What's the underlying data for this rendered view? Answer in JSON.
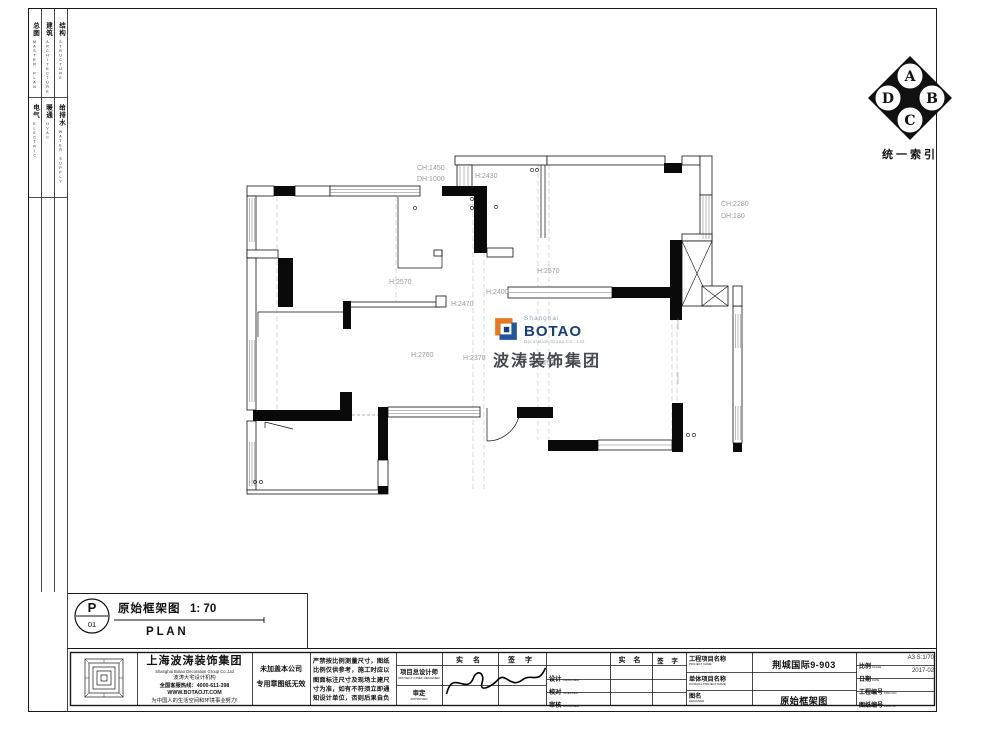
{
  "index_strip": {
    "rows": [
      {
        "cells": [
          {
            "zh": "总图",
            "en": "MASTER PLAN"
          },
          {
            "zh": "建筑",
            "en": "ARCHITECTURE"
          },
          {
            "zh": "结构",
            "en": "STRUCTURE"
          }
        ]
      },
      {
        "cells": [
          {
            "zh": "电气",
            "en": "ELECTRIC"
          },
          {
            "zh": "暖通",
            "en": "HVAC"
          },
          {
            "zh": "给排水",
            "en": "WATER SUPPLY"
          }
        ]
      }
    ]
  },
  "north_index": {
    "a": "A",
    "b": "B",
    "c": "C",
    "d": "D",
    "label": "统一索引"
  },
  "plan": {
    "dims": [
      {
        "text": "CH:1450"
      },
      {
        "text": "DH:1000"
      },
      {
        "text": "H:2430"
      },
      {
        "text": "CH:2280"
      },
      {
        "text": "DH:180"
      },
      {
        "text": "H:2570"
      },
      {
        "text": "H:2400"
      },
      {
        "text": "H:2570"
      },
      {
        "text": "H:2470"
      },
      {
        "text": "H:2760"
      },
      {
        "text": "H:2370"
      },
      {
        "text": "H:2530"
      }
    ],
    "logo": {
      "shanghai": "Shanghai",
      "botao": "BOTAO",
      "sub": "Decoration Group Co., Ltd.",
      "cn": "波涛装饰集团"
    }
  },
  "plan_label": {
    "p": "P",
    "num": "01",
    "title": "原始框架图",
    "scale": "1: 70",
    "plan": "P L A N"
  },
  "titleblock": {
    "company": {
      "name": "上海波涛装饰集团",
      "name_en": "Shanghai Botao Decoration Group Co.,Ltd",
      "org": "波涛大宅设计机构",
      "hotline": "全国客服热线：4000-611-398",
      "website": "WWW.BOTAOJT.COM",
      "slogan": "为中国人的生活空间和环境事业努力!"
    },
    "seal": {
      "line1": "未加盖本公司",
      "line2": "专用章图纸无效"
    },
    "disclaimer": {
      "l1": "严禁按比例测量尺寸，图纸",
      "l2": "比例仅供参考，施工时应以",
      "l3": "图面标注尺寸及现场土建尺",
      "l4": "寸为准，如有不符须立即通",
      "l5": "知设计单位，否则后果自负"
    },
    "cols": {
      "real_name": "实 名",
      "sign": "签 字"
    },
    "roles": {
      "chief_zh": "项目总设计师",
      "chief_en": "PROJECT CHIEF DESIGNER",
      "approved_zh": "审定",
      "approved_en": "APPROVED",
      "designed_zh": "设计",
      "designed_en": "DESIGNED",
      "checked_zh": "校对",
      "checked_en": "CHECKED",
      "examined_zh": "审核",
      "examined_en": "EXAMINED"
    },
    "project": {
      "name_label_zh": "工程项目名称",
      "name_label_en": "PROJECT NAME",
      "name_value": "荆城国际9-903",
      "unit_label_zh": "单体项目名称",
      "unit_label_en": "DIVIDUAL PROJECT NAME",
      "unit_value": "",
      "dwg_label_zh": "图名",
      "dwg_label_en": "DESIGNER",
      "dwg_value": "原始框架图"
    },
    "meta": {
      "scale_zh": "比例",
      "scale_en": "SCALE",
      "scale_value": "A3 S:1/70",
      "date_zh": "日期",
      "date_en": "DATE",
      "date_value": "2017-02",
      "projno_zh": "工程编号",
      "projno_en": "PROJ NO",
      "projno_value": "",
      "dwgno_zh": "图纸编号",
      "dwgno_en": "DWG NO",
      "dwgno_value": ""
    }
  }
}
